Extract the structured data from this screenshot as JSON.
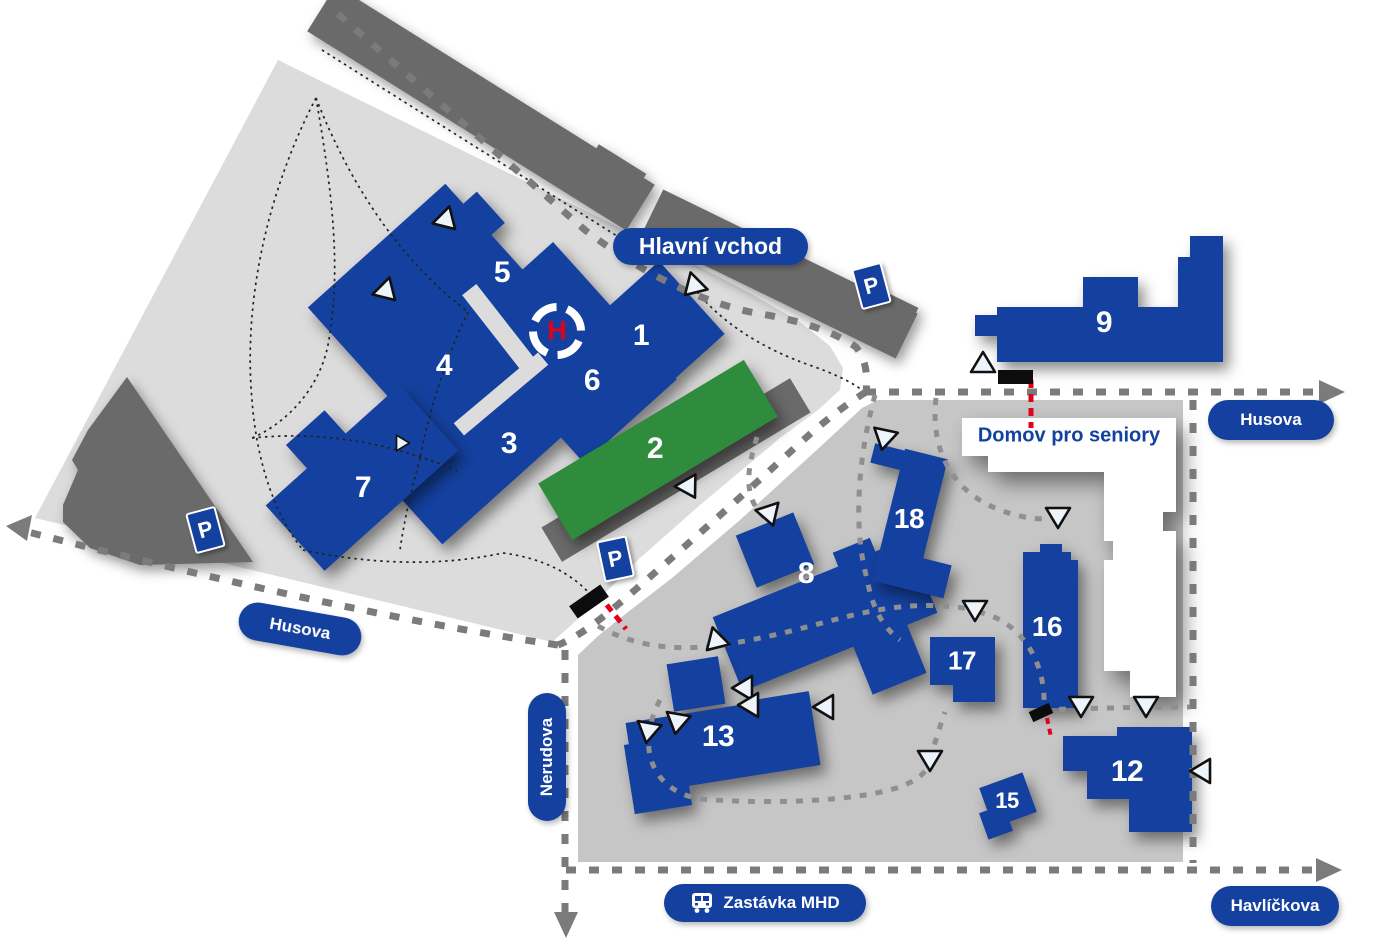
{
  "labels": {
    "main_entrance": "Hlavní vchod",
    "senior_home": "Domov pro seniory",
    "bus_stop": "Zastávka MHD",
    "street_husova_west": "Husova",
    "street_husova_east": "Husova",
    "street_nerudova": "Nerudova",
    "street_havlickova": "Havlíčkova"
  },
  "markers": {
    "parking": "P",
    "helipad": "H"
  },
  "buildings": {
    "b1": "1",
    "b2": "2",
    "b3": "3",
    "b4": "4",
    "b5": "5",
    "b6": "6",
    "b7": "7",
    "b8": "8",
    "b9": "9",
    "b12": "12",
    "b13": "13",
    "b15": "15",
    "b16": "16",
    "b17": "17",
    "b18": "18"
  },
  "colors": {
    "building_blue": "#14419F",
    "building_green": "#2F8C3C",
    "road_dark": "#6A6A6A",
    "campus_light": "#DCDCDC",
    "campus_lower": "#C6C6C6",
    "dash_gray": "#7B7B7B",
    "path_gray": "#8F8F8F",
    "accent_red": "#E2001A"
  }
}
